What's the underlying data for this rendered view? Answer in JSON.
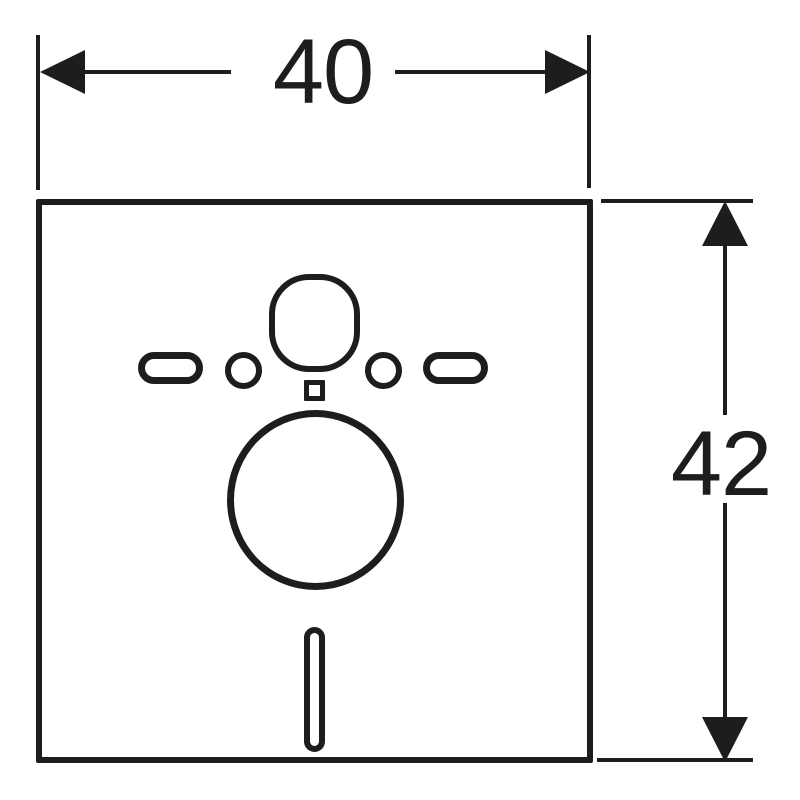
{
  "drawing": {
    "kind": "technical-dimension-drawing",
    "background_color": "#ffffff",
    "stroke_color": "#1d1d1b",
    "width_dimension": {
      "label": "40"
    },
    "height_dimension": {
      "label": "42"
    },
    "parts": {
      "panel": "square-panel-outline",
      "cutouts": [
        "flush-pipe-cutout",
        "left-oblong-cutout",
        "left-bolt-hole",
        "center-square-cutout",
        "right-bolt-hole",
        "right-oblong-cutout",
        "drain-pipe-cutout",
        "bottom-slot-cutout"
      ]
    }
  }
}
